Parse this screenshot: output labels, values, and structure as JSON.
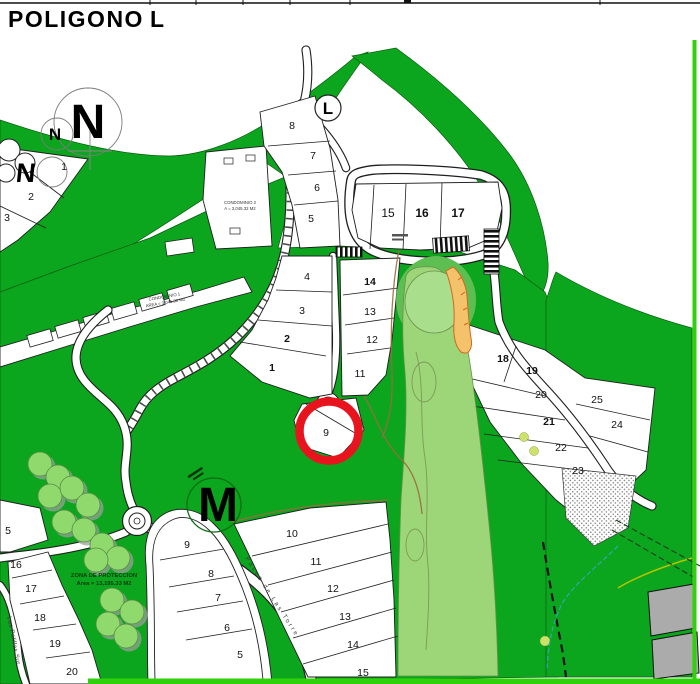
{
  "title": {
    "word1": "POLIGONO",
    "word2": "L"
  },
  "compass": {
    "primary": "N",
    "secondary": "N"
  },
  "markers": {
    "section_l": "L",
    "section_m": "M",
    "section_n": "N",
    "section_n_lot": "1"
  },
  "lots": {
    "l_upper": [
      "8",
      "7",
      "6",
      "5"
    ],
    "l_loop": [
      "15",
      "16",
      "17"
    ],
    "l_mid_left": [
      "4",
      "3",
      "2",
      "1"
    ],
    "l_mid_right": [
      "14",
      "13",
      "12",
      "11"
    ],
    "l_circled": "9",
    "east_left": [
      "18",
      "19",
      "20",
      "21",
      "22",
      "23"
    ],
    "east_right": [
      "25",
      "24"
    ],
    "m_oval": [
      "9",
      "8",
      "7",
      "6",
      "5"
    ],
    "m_right": [
      "10",
      "11",
      "12",
      "13",
      "14",
      "15"
    ],
    "west_top": [
      "2",
      "3"
    ],
    "west_strip": [
      "5",
      "16",
      "17",
      "18",
      "19",
      "20"
    ]
  },
  "labels": {
    "zona_line1": "ZONA DE PROTECCION",
    "zona_line2": "Area = 13,195.33 M2",
    "cond1_line1": "CONDOMINIO 1",
    "cond1_line2": "AREA = 3,045.32 M2",
    "cond2_line1": "CONDOMINIO 2",
    "cond2_line2": "A = 3,045.32 M2",
    "road_m": "Paseo de Las Torre",
    "road_west": "Las Polillas Sur"
  },
  "colors": {
    "green": "#0ca51e",
    "border-green": "#2fd20a",
    "fairway": "#9cd679",
    "pgreen": "#a9de8d",
    "midgreen": "#5dbf52",
    "tree": "#8fd96d",
    "sand": "#f4c26a",
    "sand-edge": "#d2691e",
    "red": "#e8141e",
    "building": "#ababab",
    "teal": "#2fa8a4",
    "lime": "#b5c400",
    "brown": "#9a6b3f"
  }
}
